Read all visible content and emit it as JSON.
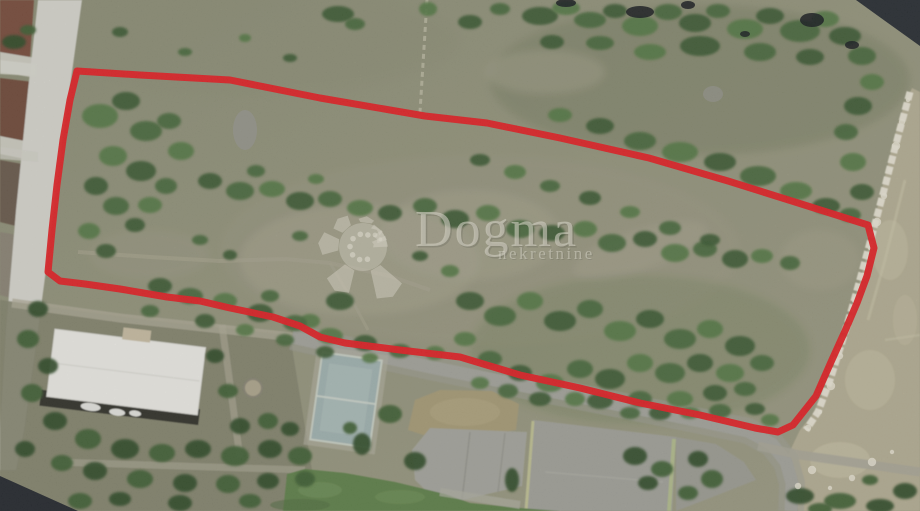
{
  "photo": {
    "kind": "aerial drone orthophoto of a land parcel for sale",
    "alt": "Overhead drone photo of scrubland parcel outlined in red, with access road on the left, building with white roof and sports courts at the bottom, open field on the right"
  },
  "watermark": {
    "brand": "Dogma",
    "subtitle": "nekretnine",
    "text_color": "#e7e4d5",
    "opacity": 0.6
  },
  "boundary": {
    "color": "#e81d22",
    "stroke_width": 7,
    "points": [
      [
        77,
        71
      ],
      [
        140,
        75
      ],
      [
        230,
        80
      ],
      [
        320,
        98
      ],
      [
        425,
        116
      ],
      [
        487,
        123
      ],
      [
        560,
        138
      ],
      [
        649,
        158
      ],
      [
        728,
        181
      ],
      [
        795,
        202
      ],
      [
        868,
        225
      ],
      [
        874,
        248
      ],
      [
        867,
        276
      ],
      [
        857,
        303
      ],
      [
        845,
        331
      ],
      [
        831,
        362
      ],
      [
        816,
        396
      ],
      [
        793,
        425
      ],
      [
        778,
        432
      ],
      [
        755,
        428
      ],
      [
        700,
        415
      ],
      [
        640,
        403
      ],
      [
        580,
        388
      ],
      [
        520,
        375
      ],
      [
        460,
        357
      ],
      [
        400,
        350
      ],
      [
        345,
        343
      ],
      [
        320,
        337
      ],
      [
        300,
        326
      ],
      [
        273,
        317
      ],
      [
        230,
        308
      ],
      [
        200,
        301
      ],
      [
        167,
        297
      ],
      [
        120,
        289
      ],
      [
        85,
        284
      ],
      [
        60,
        281
      ],
      [
        48,
        272
      ],
      [
        52,
        230
      ],
      [
        57,
        185
      ],
      [
        63,
        140
      ],
      [
        70,
        100
      ]
    ]
  },
  "colors": {
    "boundary_red": "#e81d22",
    "watermark": "#e7e4d5",
    "terrain_scrub": "#95967d",
    "vegetation_green": "#47693a",
    "access_road_white": "#dad9d1",
    "tilled_field_brown": "#74493a",
    "right_field_tan": "#b7b095",
    "asphalt_gray": "#a5a59d",
    "lawn_green": "#5f8149",
    "roof_white": "#f0efe9",
    "mosaic_void_dark": "#262b31",
    "stone_wall_white": "#ece8d8",
    "blue_court": "#a2b4b2"
  },
  "scene": {
    "features": [
      "red parcel boundary outline",
      "scrubland parcel with scattered bushes",
      "white access road (left)",
      "tilled field plots (left of road)",
      "stone wall path (right)",
      "open tan field (right)",
      "asphalt road (bottom)",
      "sports courts and concrete pads (bottom)",
      "small blue playground court",
      "green lawn (bottom)",
      "building with white roof (bottom-left)",
      "garden with trees around building",
      "dark orthophoto void corners (top-right, bottom-left)"
    ]
  }
}
